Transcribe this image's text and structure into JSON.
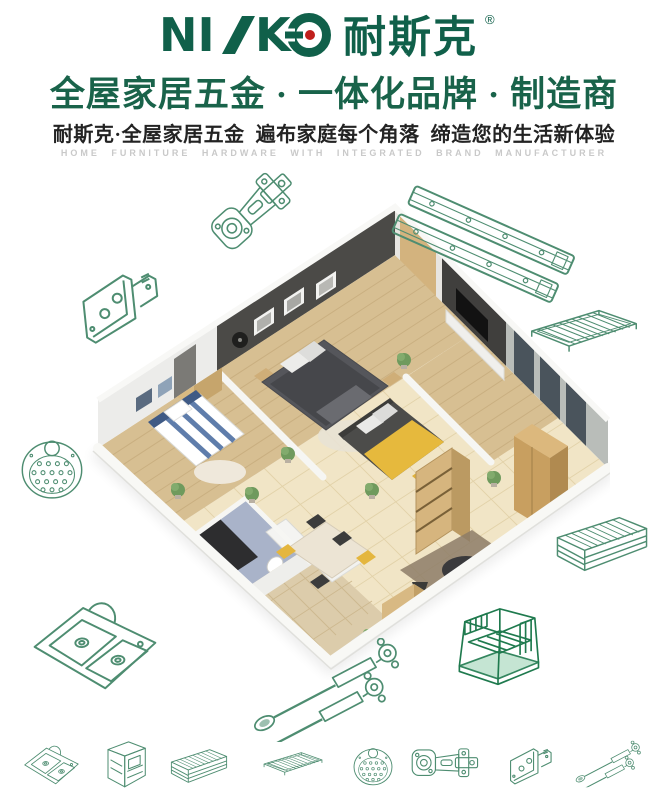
{
  "brand": {
    "full_name": "NISKO",
    "part1": "NI",
    "part2": "K",
    "name_cn": "耐斯克",
    "registered": "®"
  },
  "header": {
    "headline": "全屋家居五金 · 一体化品牌 · 制造商",
    "subheadline": "耐斯克·全屋家居五金  遍布家庭每个角落  缔造您的生活新体验",
    "tagline_en": "HOME FURNITURE HARDWARE WITH INTEGRATED BRAND MANUFACTURER"
  },
  "colors": {
    "brand_green": "#10604a",
    "headline_green": "#19634a",
    "line_art_green": "#4e8d71",
    "rack_green": "#1f7a4e",
    "accent_red": "#c0201c",
    "tagline_gray": "#c9c9c9",
    "text_dark": "#232323"
  },
  "illustration": {
    "scene": "3d-isometric-apartment-floorplan"
  },
  "hardware_icons": {
    "surrounding": [
      "cabinet-hinge",
      "ball-bearing-drawer-slides",
      "corner-bracket",
      "wire-shelf",
      "sink-strainer",
      "wire-basket-drawer",
      "double-bowl-sink",
      "gas-lift-struts",
      "kitchen-dish-rack"
    ],
    "bottom_row": [
      "double-bowl-sink",
      "pull-out-basket-cabinet",
      "wire-basket-drawer",
      "wire-shelf",
      "sink-strainer",
      "cabinet-hinge",
      "corner-bracket",
      "gas-lift-struts"
    ]
  }
}
